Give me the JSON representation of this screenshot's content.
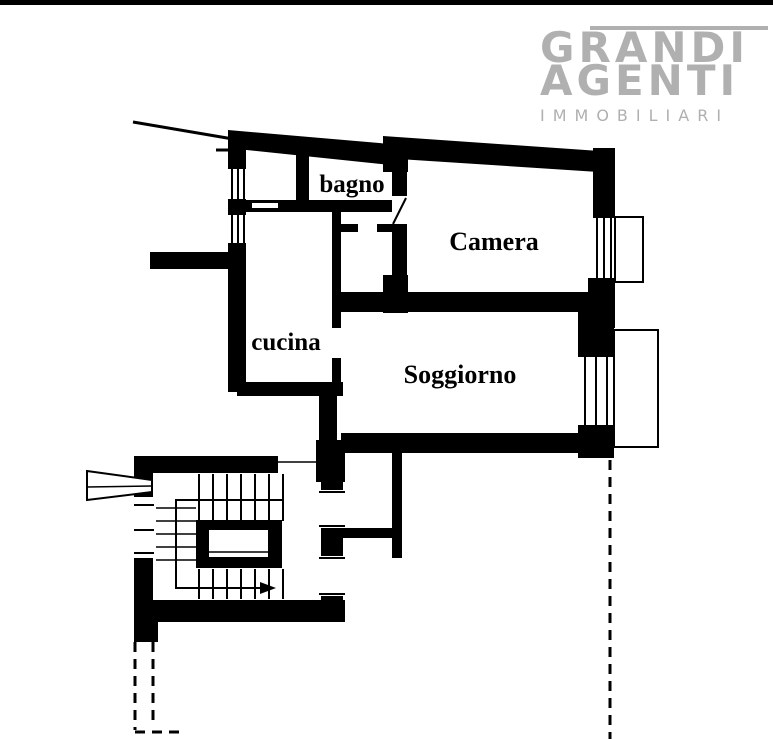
{
  "brand": {
    "name_line1": "GRANDI",
    "name_line2": "AGENTI",
    "tagline": "IMMOBILIARI",
    "color": "#b0b0b0"
  },
  "floorplan": {
    "wall_color": "#000000",
    "rooms": [
      {
        "id": "bagno",
        "label": "bagno"
      },
      {
        "id": "camera",
        "label": "Camera"
      },
      {
        "id": "cucina",
        "label": "cucina"
      },
      {
        "id": "soggiorno",
        "label": "Soggiorno"
      }
    ]
  }
}
